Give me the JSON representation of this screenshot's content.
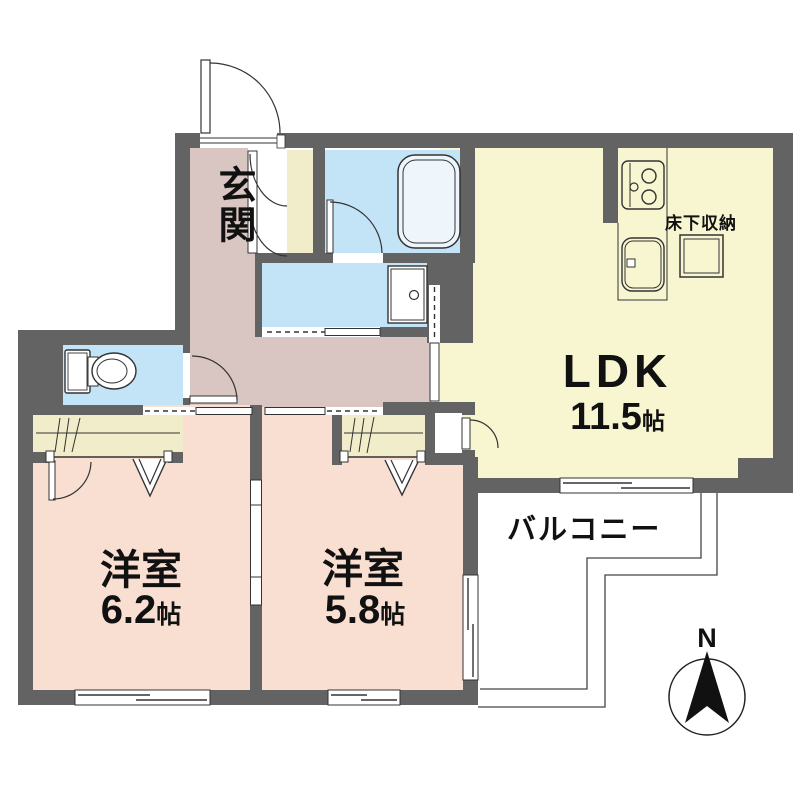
{
  "plan": {
    "rooms": {
      "genkan": {
        "label": "玄関"
      },
      "ldk": {
        "label": "LDK",
        "size_value": "11.5",
        "size_unit": "帖"
      },
      "bedroom1": {
        "label": "洋室",
        "size_value": "6.2",
        "size_unit": "帖"
      },
      "bedroom2": {
        "label": "洋室",
        "size_value": "5.8",
        "size_unit": "帖"
      },
      "balcony": {
        "label": "バルコニー"
      },
      "underfloor_storage": {
        "label": "床下収納"
      }
    },
    "compass": {
      "north_label": "N"
    },
    "fixtures": [
      "bathtub-icon",
      "toilet-icon",
      "washing-machine-icon",
      "stove-icon",
      "kitchen-sink-icon"
    ],
    "colors": {
      "wall": "#636363",
      "line": "#333333",
      "mauve": "#d9c6c2",
      "pink": "#f9ded2",
      "yellow": "#f8f6d0",
      "cream": "#f1ecca",
      "blue": "#c3e3f6",
      "tub": "#eef6fc",
      "ink": "#111111"
    }
  }
}
